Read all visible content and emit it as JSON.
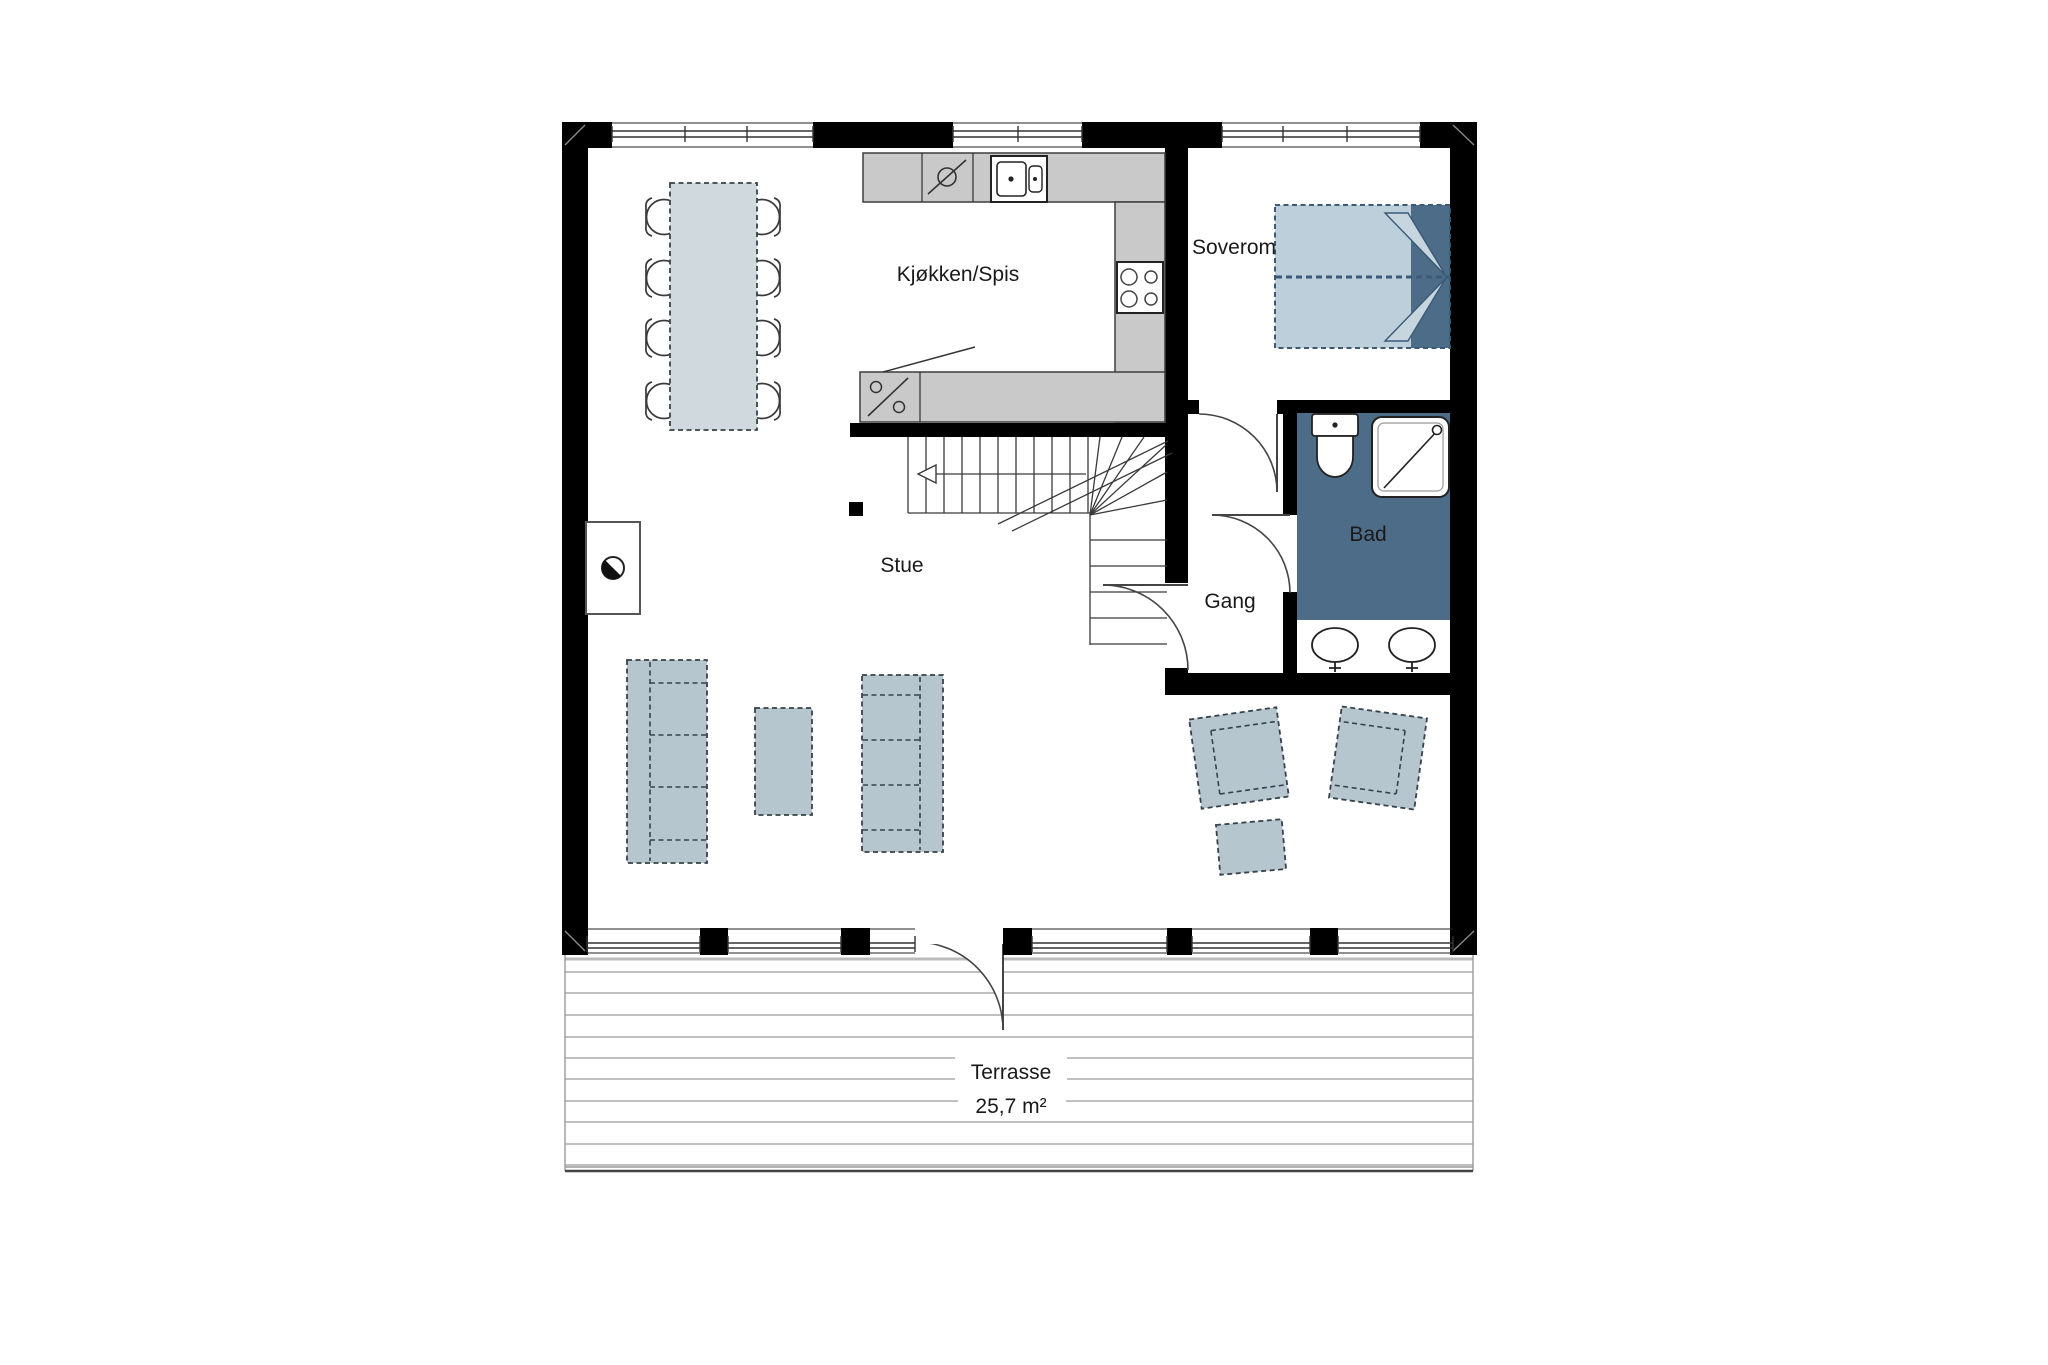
{
  "rooms": {
    "kitchen_dining": {
      "label": "Kjøkken/Spis"
    },
    "bedroom": {
      "label": "Soverom"
    },
    "bathroom": {
      "label": "Bad"
    },
    "hallway": {
      "label": "Gang"
    },
    "living_room": {
      "label": "Stue"
    },
    "terrace": {
      "label": "Terrasse",
      "area": "25,7 m²"
    }
  },
  "colors": {
    "wall": "#000000",
    "counter_fill": "#c9c9c9",
    "bathroom_floor": "#4d6c88",
    "bed_dark": "#4d6c88",
    "bed_light": "#bccfda",
    "pillow_light": "#c6d5de",
    "furniture_fill": "#b5c6ce",
    "table_fill": "#d0d9dd",
    "terrace_line": "#9a9a9a"
  },
  "fixtures": {
    "kitchen_sink": "double-basin-sink",
    "dishwasher": "appliance-slash-circle",
    "cooktop": "four-burner-stove",
    "oven_symbol": "percent-appliance",
    "bed": "double-bed",
    "toilet": "toilet",
    "shower": "shower-cabin",
    "vanity": "double-vanity-sinks",
    "wood_stove": "wood-stove",
    "stairs": "l-shaped-stair-up"
  }
}
